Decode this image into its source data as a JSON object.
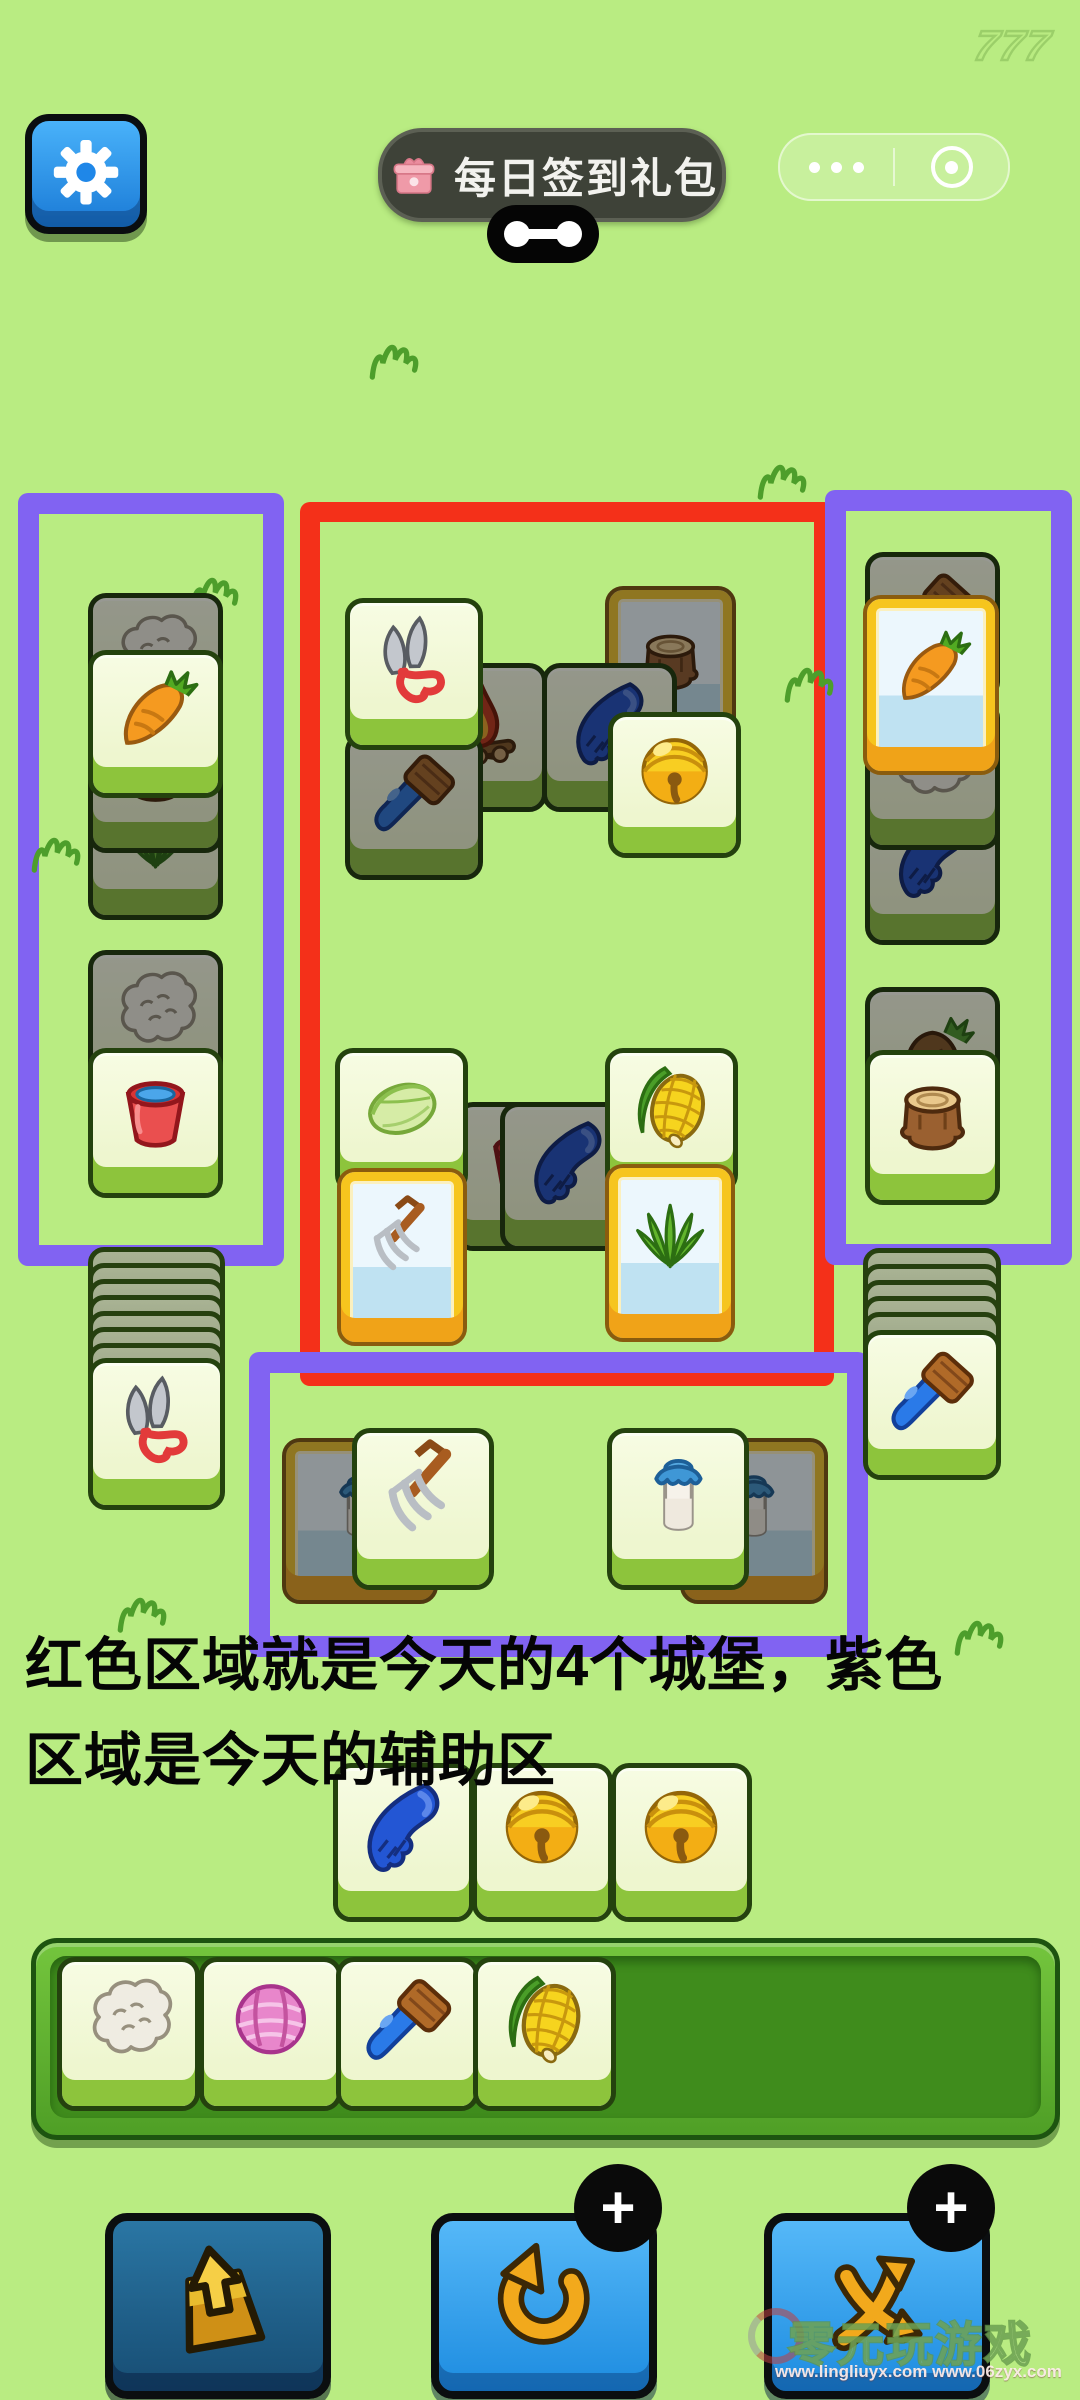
{
  "hud": {
    "score_watermark": "777",
    "signin": {
      "label": "每日签到礼包"
    }
  },
  "caption": {
    "line1": "红色区域就是今天的4个城堡，紫色",
    "line2": "区域是今天的辅助区"
  },
  "colors": {
    "background": "#b9ec82",
    "castle_zone_red": "#f43019",
    "helper_zone_purple": "#8163f2",
    "tile_face": "#f4fadc",
    "tile_lip_green": "#8dc43c",
    "frame_gold": "#f6c51e",
    "frame_bar_orange": "#f0a318"
  },
  "board": {
    "zones": [
      {
        "name": "helper-left",
        "x": 18,
        "y": 493,
        "w": 224,
        "h": 731,
        "color": "#8163f2",
        "bw": 21
      },
      {
        "name": "castle-red",
        "x": 300,
        "y": 502,
        "w": 494,
        "h": 844,
        "color": "#f43019",
        "bw": 20
      },
      {
        "name": "helper-right",
        "x": 825,
        "y": 490,
        "w": 205,
        "h": 733,
        "color": "#8163f2",
        "bw": 21
      },
      {
        "name": "helper-bottom",
        "x": 249,
        "y": 1352,
        "w": 577,
        "h": 263,
        "color": "#8163f2",
        "bw": 21
      }
    ],
    "decorations": [
      {
        "x": 180,
        "y": 545
      },
      {
        "x": 360,
        "y": 312
      },
      {
        "x": 748,
        "y": 432
      },
      {
        "x": 22,
        "y": 805
      },
      {
        "x": 775,
        "y": 635
      },
      {
        "x": 108,
        "y": 1565
      },
      {
        "x": 945,
        "y": 1588
      }
    ],
    "backs": [
      {
        "x": 88,
        "y": 1247,
        "w": 127,
        "n": 7,
        "step": 16
      },
      {
        "x": 863,
        "y": 1248,
        "w": 128,
        "n": 5,
        "step": 16
      }
    ],
    "tiles": [
      {
        "icon": "wool",
        "dim": true,
        "x": 88,
        "y": 593,
        "w": 125,
        "h": 138
      },
      {
        "icon": "grass",
        "dim": true,
        "x": 88,
        "y": 772,
        "w": 125,
        "h": 138
      },
      {
        "icon": "stump",
        "dim": true,
        "x": 88,
        "y": 705,
        "w": 125,
        "h": 138
      },
      {
        "icon": "carrot",
        "dim": false,
        "x": 88,
        "y": 650,
        "w": 125,
        "h": 138
      },
      {
        "icon": "wool",
        "dim": true,
        "x": 88,
        "y": 950,
        "w": 125,
        "h": 138
      },
      {
        "icon": "bucket",
        "dim": false,
        "x": 88,
        "y": 1048,
        "w": 125,
        "h": 140
      },
      {
        "icon": "fire",
        "dim": true,
        "x": 412,
        "y": 663,
        "w": 125,
        "h": 139
      },
      {
        "icon": "brush",
        "dim": true,
        "x": 345,
        "y": 733,
        "w": 128,
        "h": 137
      },
      {
        "icon": "scissors",
        "dim": false,
        "x": 345,
        "y": 598,
        "w": 128,
        "h": 142
      },
      {
        "icon": "stump",
        "dim": true,
        "framed": true,
        "x": 605,
        "y": 586,
        "w": 123,
        "h": 168
      },
      {
        "icon": "glove",
        "dim": true,
        "x": 542,
        "y": 663,
        "w": 125,
        "h": 139
      },
      {
        "icon": "bell",
        "dim": false,
        "x": 608,
        "y": 712,
        "w": 123,
        "h": 136
      },
      {
        "icon": "bucket",
        "dim": true,
        "x": 455,
        "y": 1102,
        "w": 125,
        "h": 139
      },
      {
        "icon": "cabbage",
        "dim": false,
        "x": 335,
        "y": 1048,
        "w": 123,
        "h": 135
      },
      {
        "icon": "pitchfork",
        "dim": false,
        "framed": true,
        "x": 337,
        "y": 1168,
        "w": 122,
        "h": 170
      },
      {
        "icon": "glove",
        "dim": true,
        "x": 500,
        "y": 1102,
        "w": 125,
        "h": 139
      },
      {
        "icon": "corn",
        "dim": false,
        "x": 605,
        "y": 1048,
        "w": 123,
        "h": 135
      },
      {
        "icon": "grass",
        "dim": false,
        "framed": true,
        "x": 605,
        "y": 1164,
        "w": 122,
        "h": 170
      },
      {
        "icon": "brush",
        "dim": true,
        "x": 865,
        "y": 552,
        "w": 125,
        "h": 138
      },
      {
        "icon": "glove",
        "dim": true,
        "x": 865,
        "y": 795,
        "w": 125,
        "h": 140
      },
      {
        "icon": "wool",
        "dim": true,
        "x": 865,
        "y": 700,
        "w": 125,
        "h": 140
      },
      {
        "icon": "carrot",
        "dim": false,
        "framed": true,
        "x": 863,
        "y": 595,
        "w": 128,
        "h": 172
      },
      {
        "icon": "carrot-root",
        "dim": true,
        "x": 865,
        "y": 987,
        "w": 125,
        "h": 138
      },
      {
        "icon": "stump",
        "dim": false,
        "x": 865,
        "y": 1050,
        "w": 125,
        "h": 145
      },
      {
        "icon": "scissors",
        "dim": false,
        "x": 88,
        "y": 1358,
        "w": 127,
        "h": 142
      },
      {
        "icon": "brush",
        "dim": false,
        "x": 863,
        "y": 1330,
        "w": 128,
        "h": 140
      },
      {
        "icon": "milk",
        "dim": true,
        "framed": true,
        "x": 282,
        "y": 1438,
        "w": 148,
        "h": 158
      },
      {
        "icon": "pitchfork",
        "dim": false,
        "x": 352,
        "y": 1428,
        "w": 132,
        "h": 152
      },
      {
        "icon": "milk",
        "dim": true,
        "framed": true,
        "x": 680,
        "y": 1438,
        "w": 140,
        "h": 158
      },
      {
        "icon": "milk",
        "dim": false,
        "x": 607,
        "y": 1428,
        "w": 132,
        "h": 152
      },
      {
        "icon": "glove",
        "dim": false,
        "x": 333,
        "y": 1763,
        "w": 131,
        "h": 149
      },
      {
        "icon": "bell",
        "dim": false,
        "x": 472,
        "y": 1763,
        "w": 131,
        "h": 149
      },
      {
        "icon": "bell",
        "dim": false,
        "x": 611,
        "y": 1763,
        "w": 131,
        "h": 149
      }
    ]
  },
  "slot_bar": {
    "tiles": [
      {
        "icon": "wool",
        "x": 57,
        "y": 1957,
        "w": 133,
        "h": 144
      },
      {
        "icon": "yarn",
        "x": 199,
        "y": 1957,
        "w": 133,
        "h": 144
      },
      {
        "icon": "brush",
        "x": 336,
        "y": 1957,
        "w": 133,
        "h": 144
      },
      {
        "icon": "corn",
        "x": 473,
        "y": 1957,
        "w": 133,
        "h": 144
      }
    ]
  },
  "toolbar": {
    "buttons": [
      {
        "name": "pop-out",
        "icon": "bag-icon"
      },
      {
        "name": "undo",
        "icon": "undo-icon",
        "badge": "+"
      },
      {
        "name": "shuffle",
        "icon": "shuffle-icon",
        "badge": "+"
      }
    ]
  },
  "footer_watermark": {
    "brand": "零元玩游戏",
    "urls": "www.lingliuyx.com   www.06zyx.com"
  }
}
